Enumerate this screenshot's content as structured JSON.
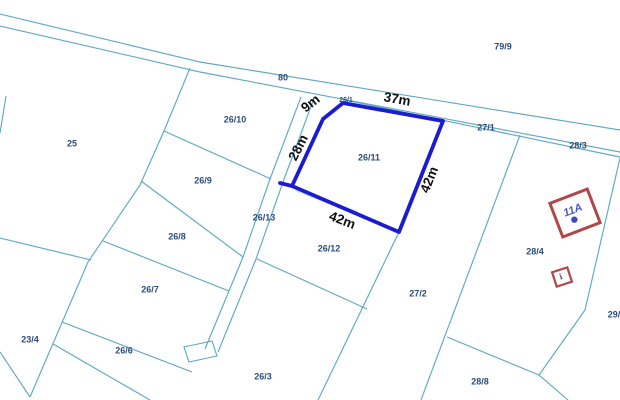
{
  "map": {
    "background": "#ffffff",
    "line_color": "#5fa9c2",
    "parcel_label_color": "#2b4d7c",
    "dimension_label_color": "#101010",
    "highlight": {
      "parcel_label": "26/11",
      "label_x": 369,
      "label_y": 158,
      "color": "#1b1bd1",
      "polygon": [
        [
          323,
          119
        ],
        [
          343,
          103
        ],
        [
          443,
          121
        ],
        [
          399,
          232
        ],
        [
          292,
          186
        ]
      ],
      "spur": [
        [
          292,
          186
        ],
        [
          280,
          183
        ]
      ],
      "dimensions": [
        {
          "text": "9m",
          "x": 311,
          "y": 104,
          "rot": -38
        },
        {
          "text": "37m",
          "x": 397,
          "y": 100,
          "rot": 10
        },
        {
          "text": "28m",
          "x": 299,
          "y": 148,
          "rot": -63
        },
        {
          "text": "42m",
          "x": 430,
          "y": 180,
          "rot": -68
        },
        {
          "text": "42m",
          "x": 342,
          "y": 221,
          "rot": 21
        }
      ]
    },
    "parcel_labels": [
      {
        "text": "79/9",
        "x": 503,
        "y": 47
      },
      {
        "text": "80",
        "x": 283,
        "y": 78
      },
      {
        "text": "26/1",
        "x": 346,
        "y": 100,
        "small": true
      },
      {
        "text": "27/1",
        "x": 486,
        "y": 128
      },
      {
        "text": "28/3",
        "x": 578,
        "y": 146
      },
      {
        "text": "25",
        "x": 72,
        "y": 144
      },
      {
        "text": "26/10",
        "x": 235,
        "y": 120
      },
      {
        "text": "26/9",
        "x": 203,
        "y": 181
      },
      {
        "text": "26/13",
        "x": 264,
        "y": 218
      },
      {
        "text": "26/8",
        "x": 177,
        "y": 237
      },
      {
        "text": "26/7",
        "x": 150,
        "y": 290
      },
      {
        "text": "23/4",
        "x": 30,
        "y": 340
      },
      {
        "text": "26/6",
        "x": 124,
        "y": 351
      },
      {
        "text": "26/12",
        "x": 329,
        "y": 249
      },
      {
        "text": "26/3",
        "x": 263,
        "y": 377
      },
      {
        "text": "27/2",
        "x": 418,
        "y": 294
      },
      {
        "text": "28/4",
        "x": 535,
        "y": 252
      },
      {
        "text": "29/",
        "x": 614,
        "y": 315
      },
      {
        "text": "28/8",
        "x": 480,
        "y": 382
      }
    ],
    "boundary_lines": [
      {
        "name": "road-top",
        "pts": [
          [
            0,
            14
          ],
          [
            200,
            62
          ],
          [
            620,
            130
          ]
        ]
      },
      {
        "name": "road-bottom",
        "pts": [
          [
            0,
            26
          ],
          [
            200,
            72
          ],
          [
            620,
            152
          ]
        ]
      },
      {
        "name": "road-strip",
        "pts": [
          [
            345,
            100
          ],
          [
            620,
            157
          ]
        ]
      },
      {
        "name": "west-diagonal",
        "pts": [
          [
            190,
            68
          ],
          [
            164,
            131
          ],
          [
            140,
            185
          ],
          [
            88,
            262
          ],
          [
            30,
            397
          ]
        ]
      },
      {
        "name": "parcel-23-4-top",
        "pts": [
          [
            0,
            238
          ],
          [
            91,
            260
          ]
        ]
      },
      {
        "name": "parcel-23-4-bottom",
        "pts": [
          [
            0,
            352
          ],
          [
            30,
            397
          ]
        ]
      },
      {
        "name": "left-edge-stub",
        "pts": [
          [
            6,
            96
          ],
          [
            0,
            133
          ]
        ]
      },
      {
        "name": "row-26-10",
        "pts": [
          [
            164,
            131
          ],
          [
            271,
            179
          ]
        ]
      },
      {
        "name": "row-26-9",
        "pts": [
          [
            141,
            181
          ],
          [
            243,
            257
          ]
        ]
      },
      {
        "name": "row-26-8",
        "pts": [
          [
            103,
            241
          ],
          [
            229,
            291
          ]
        ]
      },
      {
        "name": "row-26-7",
        "pts": [
          [
            62,
            322
          ],
          [
            192,
            372
          ]
        ]
      },
      {
        "name": "row-26-6",
        "pts": [
          [
            53,
            344
          ],
          [
            150,
            400
          ]
        ]
      },
      {
        "name": "strip-26-13-west",
        "pts": [
          [
            301,
            97
          ],
          [
            270,
            179
          ],
          [
            243,
            257
          ],
          [
            205,
            349
          ]
        ]
      },
      {
        "name": "strip-26-13-east",
        "pts": [
          [
            313,
            101
          ],
          [
            283,
            182
          ],
          [
            256,
            259
          ],
          [
            218,
            352
          ]
        ]
      },
      {
        "name": "east-of-26-12",
        "pts": [
          [
            399,
            232
          ],
          [
            318,
            400
          ]
        ]
      },
      {
        "name": "row-26-12",
        "pts": [
          [
            257,
            259
          ],
          [
            367,
            309
          ]
        ]
      },
      {
        "name": "east-of-27-2",
        "pts": [
          [
            520,
            135
          ],
          [
            421,
            400
          ]
        ]
      },
      {
        "name": "row-28-4",
        "pts": [
          [
            447,
            337
          ],
          [
            539,
            375
          ]
        ]
      },
      {
        "name": "east-of-28-4",
        "pts": [
          [
            620,
            158
          ],
          [
            585,
            310
          ],
          [
            539,
            375
          ],
          [
            568,
            400
          ]
        ]
      },
      {
        "name": "under-highlight",
        "pts": [
          [
            293,
            187
          ],
          [
            399,
            233
          ]
        ]
      }
    ],
    "strip_end_rect": [
      [
        184,
        347
      ],
      [
        212,
        341
      ],
      [
        217,
        356
      ],
      [
        189,
        362
      ]
    ],
    "watermark_streak": {
      "d": "M 296,190 C 312,197 332,204 358,212",
      "color": "#a4cbe0"
    },
    "buildings": [
      {
        "name": "building-11A",
        "cx": 575,
        "cy": 213,
        "w": 40,
        "h": 36,
        "rot": -21,
        "border": "#b04848",
        "label": "11A",
        "label_color": "#4a5cc8",
        "dot": true
      },
      {
        "name": "building-i",
        "cx": 562,
        "cy": 277,
        "w": 16,
        "h": 15,
        "rot": -18,
        "border": "#b04848",
        "label": "i",
        "label_color": "#6b3a3a",
        "dot": false
      }
    ]
  }
}
